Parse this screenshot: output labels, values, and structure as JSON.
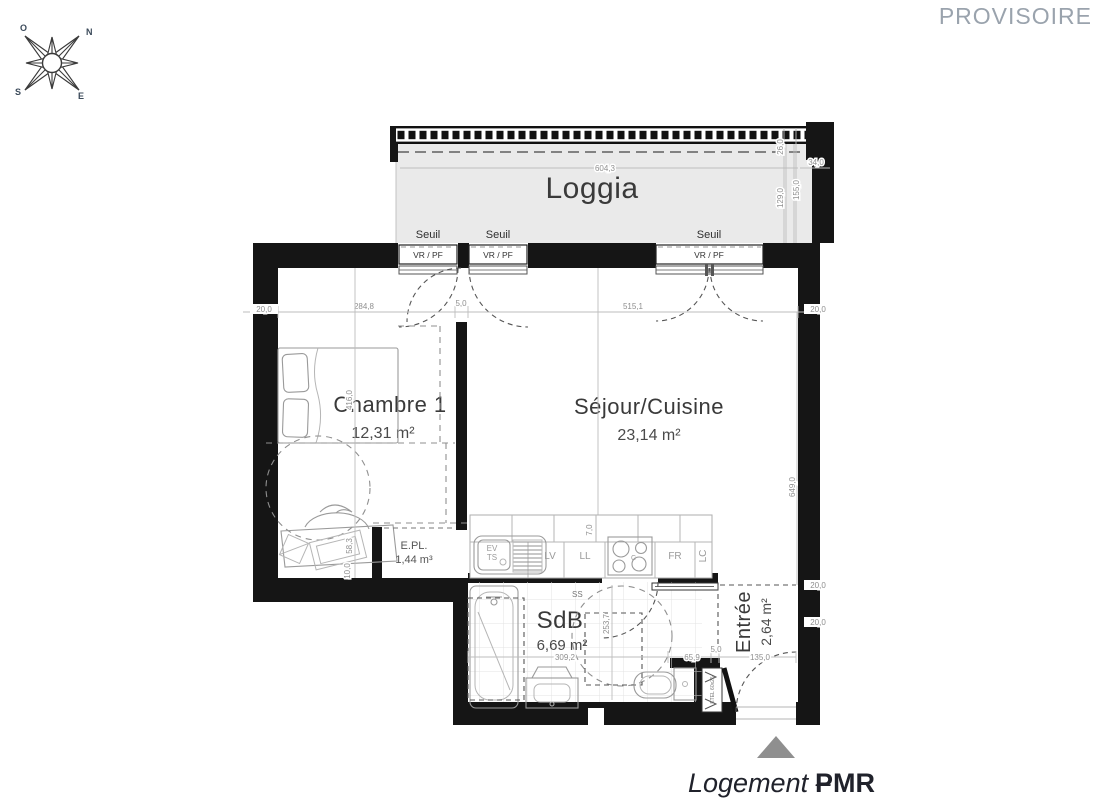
{
  "watermark": "PROVISOIRE",
  "compass": {
    "n": "N",
    "o": "O",
    "s": "S",
    "e": "E"
  },
  "footer": {
    "prefix": "Logement –",
    "suffix": "PMR"
  },
  "rooms": {
    "loggia": {
      "name": "Loggia"
    },
    "chambre1": {
      "name": "Chambre 1",
      "area": "12,31 m²"
    },
    "sejour": {
      "name": "Séjour/Cuisine",
      "area": "23,14 m²"
    },
    "epl": {
      "name": "E.PL.",
      "area": "1,44 m³"
    },
    "sdb": {
      "name": "SdB",
      "area": "6,69 m²"
    },
    "entree": {
      "name": "Entrée",
      "area": "2,64 m²"
    }
  },
  "openings": {
    "seuil": "Seuil",
    "vr_pf": "VR / PF"
  },
  "equipment": {
    "ev": "EV",
    "ts": "TS",
    "lv": "LV",
    "ll": "LL",
    "c": "C",
    "fr": "FR",
    "lc": "LC",
    "ss": "SS",
    "etel": "ETEL 60x25"
  },
  "dimensions": {
    "loggia_width": "604,3",
    "loggia_end": "34,0",
    "loggia_v1": "26,0",
    "loggia_v2": "129,0",
    "loggia_v3": "155,0",
    "d20": "20,0",
    "d5": "5,0",
    "d7": "7,0",
    "d10": "10,0",
    "chambre_width": "284,8",
    "sejour_width": "515,1",
    "chambre_height": "416,0",
    "chambre_low": "58,3",
    "sejour_height": "649,0",
    "sdb_width": "309,2",
    "sdb_height": "253,7",
    "wc_width": "65,9",
    "entree_width": "135,0"
  },
  "colors": {
    "wall": "#151515",
    "loggia_fill": "#eaeaea",
    "dim": "#8f8f8f",
    "watermark": "#9aa3ad",
    "marker": "#8f8f8f"
  }
}
